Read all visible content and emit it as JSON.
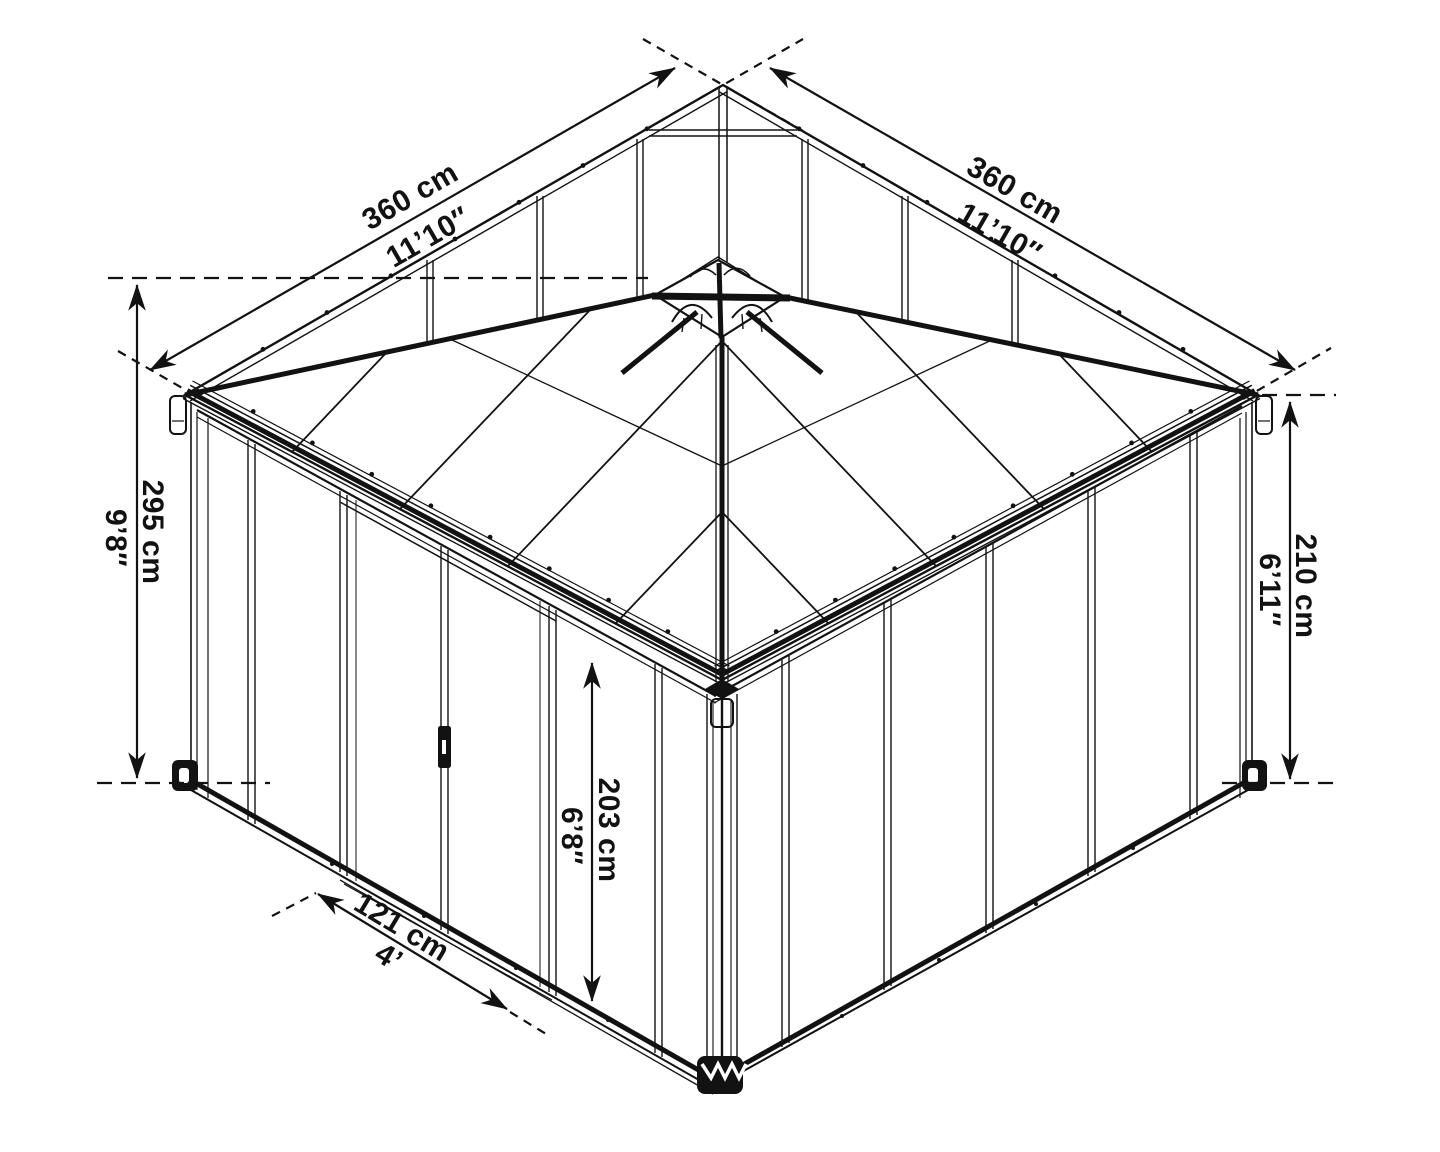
{
  "diagram": {
    "dimensions": {
      "roof_edge_left": {
        "metric": "360 cm",
        "imperial": "11’10″"
      },
      "roof_edge_right": {
        "metric": "360 cm",
        "imperial": "11’10″"
      },
      "total_height": {
        "metric": "295 cm",
        "imperial": "9’8″"
      },
      "wall_height": {
        "metric": "210 cm",
        "imperial": "6’11″"
      },
      "door_height": {
        "metric": "203 cm",
        "imperial": "6’8″"
      },
      "door_width": {
        "metric": "121 cm",
        "imperial": "4’"
      }
    },
    "line_color": "#121212"
  }
}
